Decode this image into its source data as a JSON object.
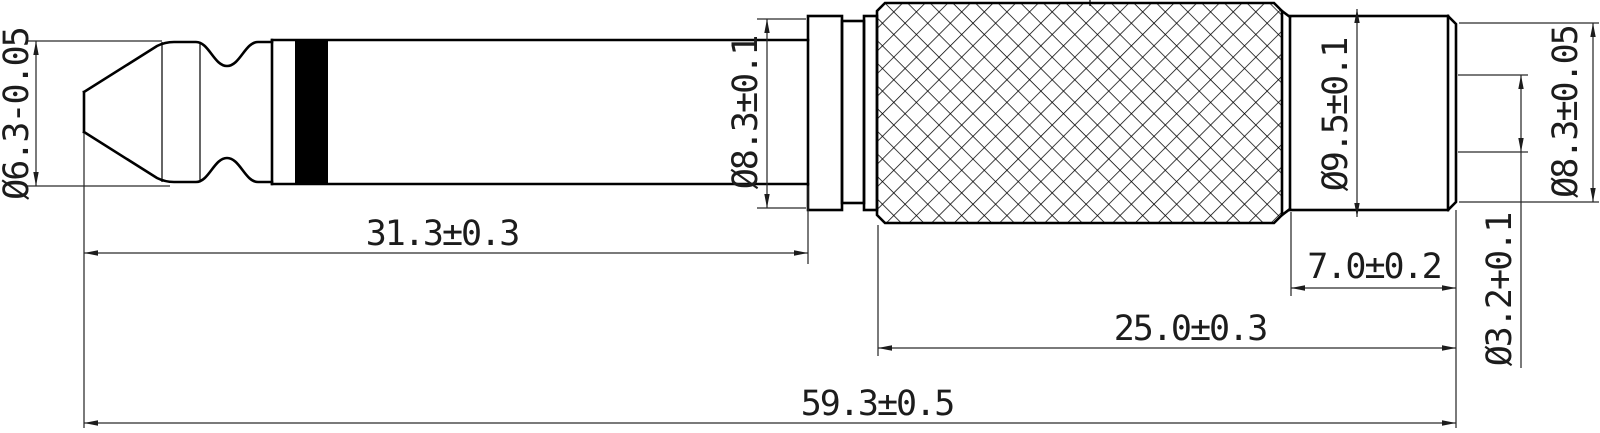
{
  "drawing": {
    "kind": "technical-drawing",
    "background_color": "#ffffff",
    "line_color": "#000000",
    "labels": {
      "tip_diameter": "Ø6.3-0.05",
      "tip_length": "31.3±0.3",
      "collar_diameter": "Ø8.3±0.1",
      "body_diameter": "Ø9.5±0.1",
      "neck_length": "7.0±0.2",
      "body_length": "25.0±0.3",
      "hole_diameter": "Ø3.2+0.1",
      "end_diameter": "Ø8.3±0.05",
      "overall_length": "59.3±0.5"
    }
  }
}
